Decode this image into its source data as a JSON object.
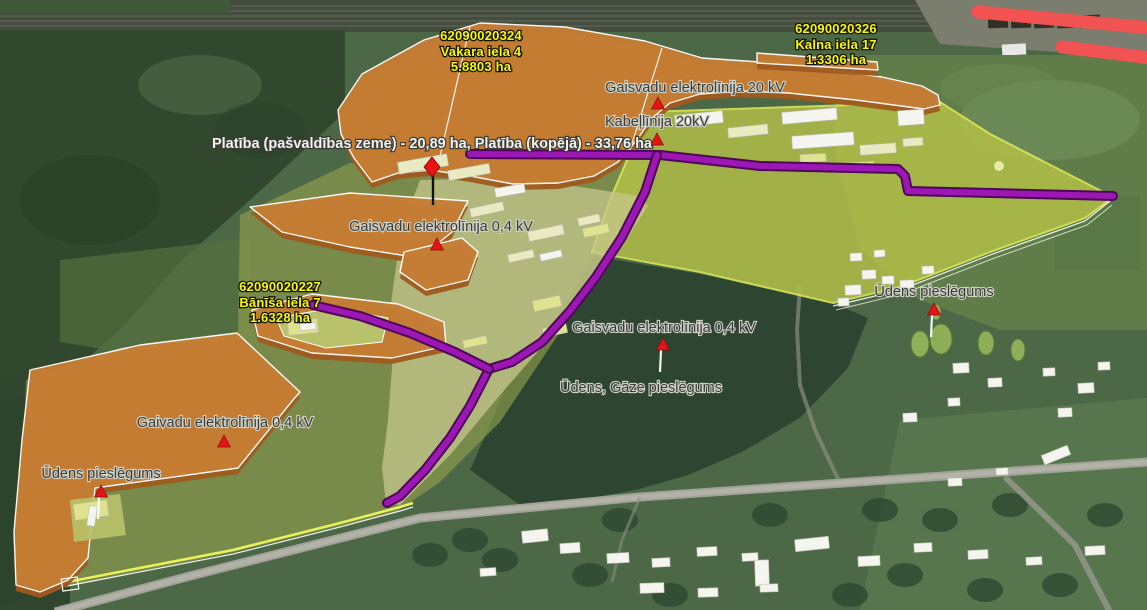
{
  "map": {
    "title": "Cadastral 3D aerial map with utility annotations",
    "colors": {
      "parcel_orange": "#c77e35",
      "parcel_orange_side": "#9f5a1e",
      "parcel_yellow": "#b5c248",
      "parcel_yellow_border": "#e9f25a",
      "utility_purple": "#9c17b4",
      "utility_purple_edge": "#4d0759",
      "corridor_red": "#f15353",
      "marker_red": "#e21414",
      "label_yellow": "#f8f800",
      "label_gray": "#3a3a3a",
      "label_white": "#f2f2f2"
    },
    "parcel_labels": [
      {
        "name": "parcel-label-62090020324",
        "x": 481,
        "lines": [
          {
            "text": "62090020324",
            "y": 40
          },
          {
            "text": "Vakara iela 4",
            "y": 56
          },
          {
            "text": "5.8803 ha",
            "y": 71
          }
        ]
      },
      {
        "name": "parcel-label-62090020326",
        "x": 836,
        "lines": [
          {
            "text": "62090020326",
            "y": 33
          },
          {
            "text": "Kalna iela 17",
            "y": 49
          },
          {
            "text": "1.3306 ha",
            "y": 64
          }
        ]
      },
      {
        "name": "parcel-label-62090020227",
        "x": 280,
        "lines": [
          {
            "text": "62090020227",
            "y": 291
          },
          {
            "text": "Bānīša iela 7",
            "y": 307
          },
          {
            "text": "1.6328 ha",
            "y": 322
          }
        ]
      }
    ],
    "infra_labels": [
      {
        "name": "label-gaisvadu-20kv",
        "text": "Gaisvadu elektrolīnija 20 kV",
        "x": 695,
        "y": 92
      },
      {
        "name": "label-kabellinija-20kv",
        "text": "Kabeļlīnija 20kV",
        "x": 657,
        "y": 126
      },
      {
        "name": "label-gaisvadu-04kv-1",
        "text": "Gaisvadu elektrolīnija 0,4 kV",
        "x": 441,
        "y": 231
      },
      {
        "name": "label-gaisvadu-04kv-2",
        "text": "Gaisvadu elektrolīnija 0,4 kV",
        "x": 664,
        "y": 332
      },
      {
        "name": "label-gaivadu-04kv",
        "text": "Gaivadu elektrolīnija 0,4 kV",
        "x": 225,
        "y": 427
      },
      {
        "name": "label-udens-pieslegums-right",
        "text": "Ūdens pieslēgums",
        "x": 934,
        "y": 296
      },
      {
        "name": "label-udens-gaze-pieslegums",
        "text": "Ūdens, Gāze pieslēgums",
        "x": 641,
        "y": 392
      },
      {
        "name": "label-udens-pieslegums-left",
        "text": "Ūdens pieslēgums",
        "x": 101,
        "y": 478
      }
    ],
    "area_label": {
      "name": "label-platiba",
      "text": "Platība (pašvaldības zeme) - 20,89 ha,  Platība (kopējā) - 33,76 ha",
      "x": 432,
      "y": 148
    },
    "markers": {
      "triangles": [
        {
          "x": 658,
          "y": 104,
          "stem": 0
        },
        {
          "x": 657,
          "y": 140,
          "stem": 0
        },
        {
          "x": 437,
          "y": 245,
          "stem": 0
        },
        {
          "x": 663,
          "y": 345,
          "stem": 22
        },
        {
          "x": 934,
          "y": 310,
          "stem": 22
        },
        {
          "x": 101,
          "y": 492,
          "stem": 22
        },
        {
          "x": 224,
          "y": 442,
          "stem": 0
        }
      ],
      "diamond": {
        "x": 432,
        "y": 167,
        "stem": 38
      }
    }
  }
}
